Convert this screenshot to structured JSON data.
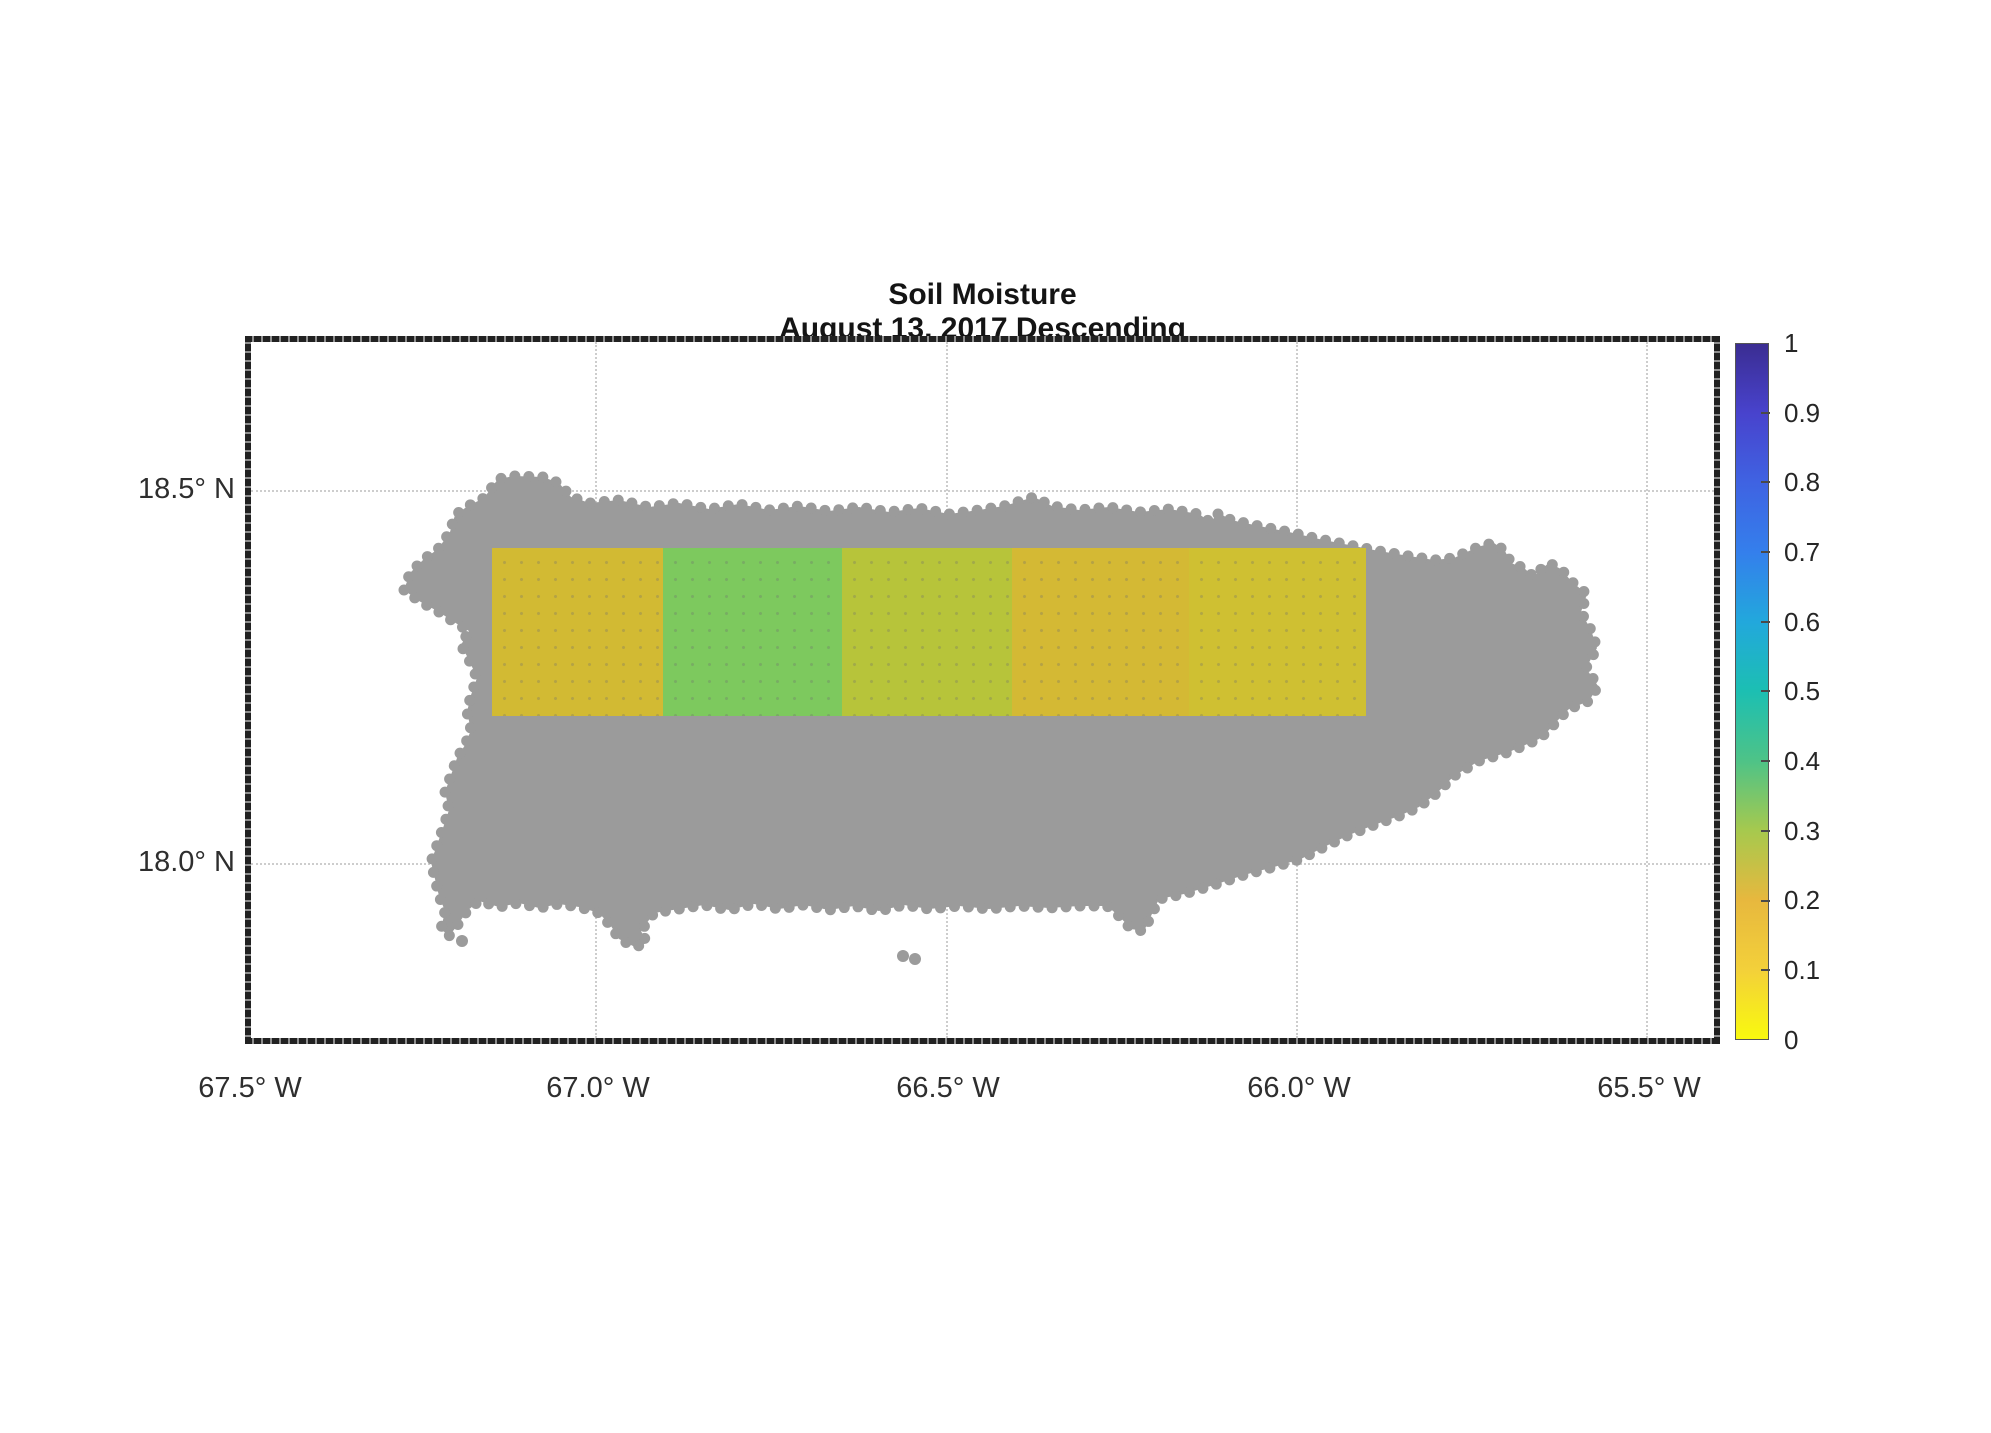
{
  "title": {
    "line1": "Soil Moisture",
    "line2": "August 13, 2017 Descending"
  },
  "axes": {
    "x_ticks": [
      "67.5° W",
      "67.0° W",
      "66.5° W",
      "66.0° W",
      "65.5° W"
    ],
    "y_ticks": [
      "18.5° N",
      "18.0° N"
    ],
    "gridlines": "dotted light gray at each labeled tick"
  },
  "colorbar": {
    "min": 0,
    "max": 1,
    "ticks": [
      "1",
      "0.9",
      "0.8",
      "0.7",
      "0.6",
      "0.5",
      "0.4",
      "0.3",
      "0.2",
      "0.1",
      "0"
    ],
    "colormap": "parula-reversed (yellow at 0 to dark indigo at 1)",
    "gradient_top_to_bottom": [
      "#3b2d92",
      "#4843cd",
      "#3f63e2",
      "#347fec",
      "#22a8dc",
      "#1cbfb2",
      "#4ec387",
      "#a6c94e",
      "#e7b83e",
      "#f3d03a",
      "#f9f90e"
    ]
  },
  "basemap": {
    "region": "Puerto Rico",
    "land_color": "#9b9b9b",
    "background_color": "#ffffff"
  },
  "chart_data": {
    "type": "heatmap",
    "title": "Soil Moisture",
    "subtitle": "August 13, 2017 Descending",
    "xlabel": "Longitude (degrees West)",
    "ylabel": "Latitude (degrees North)",
    "x_tick_labels": [
      "67.5° W",
      "67.0° W",
      "66.5° W",
      "66.0° W",
      "65.5° W"
    ],
    "y_tick_labels": [
      "18.5° N",
      "18.0° N"
    ],
    "x_range_deg_w": [
      67.49,
      65.4
    ],
    "y_range_deg_n": [
      17.76,
      18.7
    ],
    "colorbar_range": [
      0,
      1
    ],
    "grid": true,
    "legend_position": "right-colorbar",
    "cells": [
      {
        "lon_w_range": [
          67.15,
          66.9
        ],
        "lat_n_range": [
          18.2,
          18.42
        ],
        "value": 0.21,
        "color": "#d2ba33"
      },
      {
        "lon_w_range": [
          66.9,
          66.65
        ],
        "lat_n_range": [
          18.2,
          18.42
        ],
        "value": 0.33,
        "color": "#7dc95e"
      },
      {
        "lon_w_range": [
          66.65,
          66.4
        ],
        "lat_n_range": [
          18.2,
          18.42
        ],
        "value": 0.27,
        "color": "#b7c43a"
      },
      {
        "lon_w_range": [
          66.4,
          66.15
        ],
        "lat_n_range": [
          18.2,
          18.42
        ],
        "value": 0.2,
        "color": "#d4b934"
      },
      {
        "lon_w_range": [
          66.15,
          65.9
        ],
        "lat_n_range": [
          18.2,
          18.42
        ],
        "value": 0.23,
        "color": "#cfc032"
      }
    ]
  }
}
